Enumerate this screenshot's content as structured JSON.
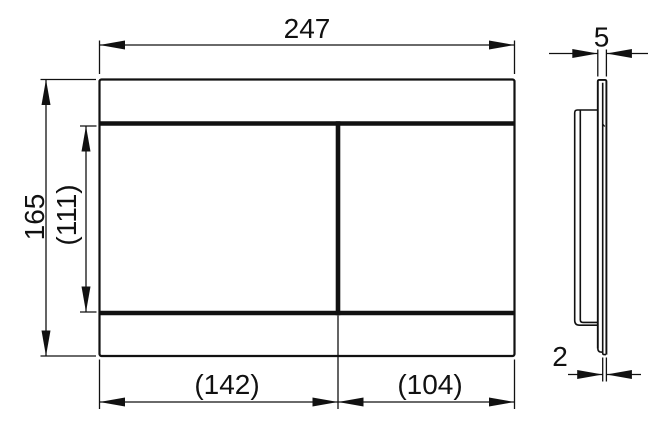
{
  "dimensions": {
    "front": {
      "overall_width": "247",
      "overall_height": "165",
      "inner_height": "(111)",
      "left_section_width": "(142)",
      "right_section_width": "(104)"
    },
    "side": {
      "plate_thickness": "5",
      "edge_thickness": "2"
    }
  },
  "colors": {
    "line": "#111111",
    "background": "#ffffff"
  }
}
